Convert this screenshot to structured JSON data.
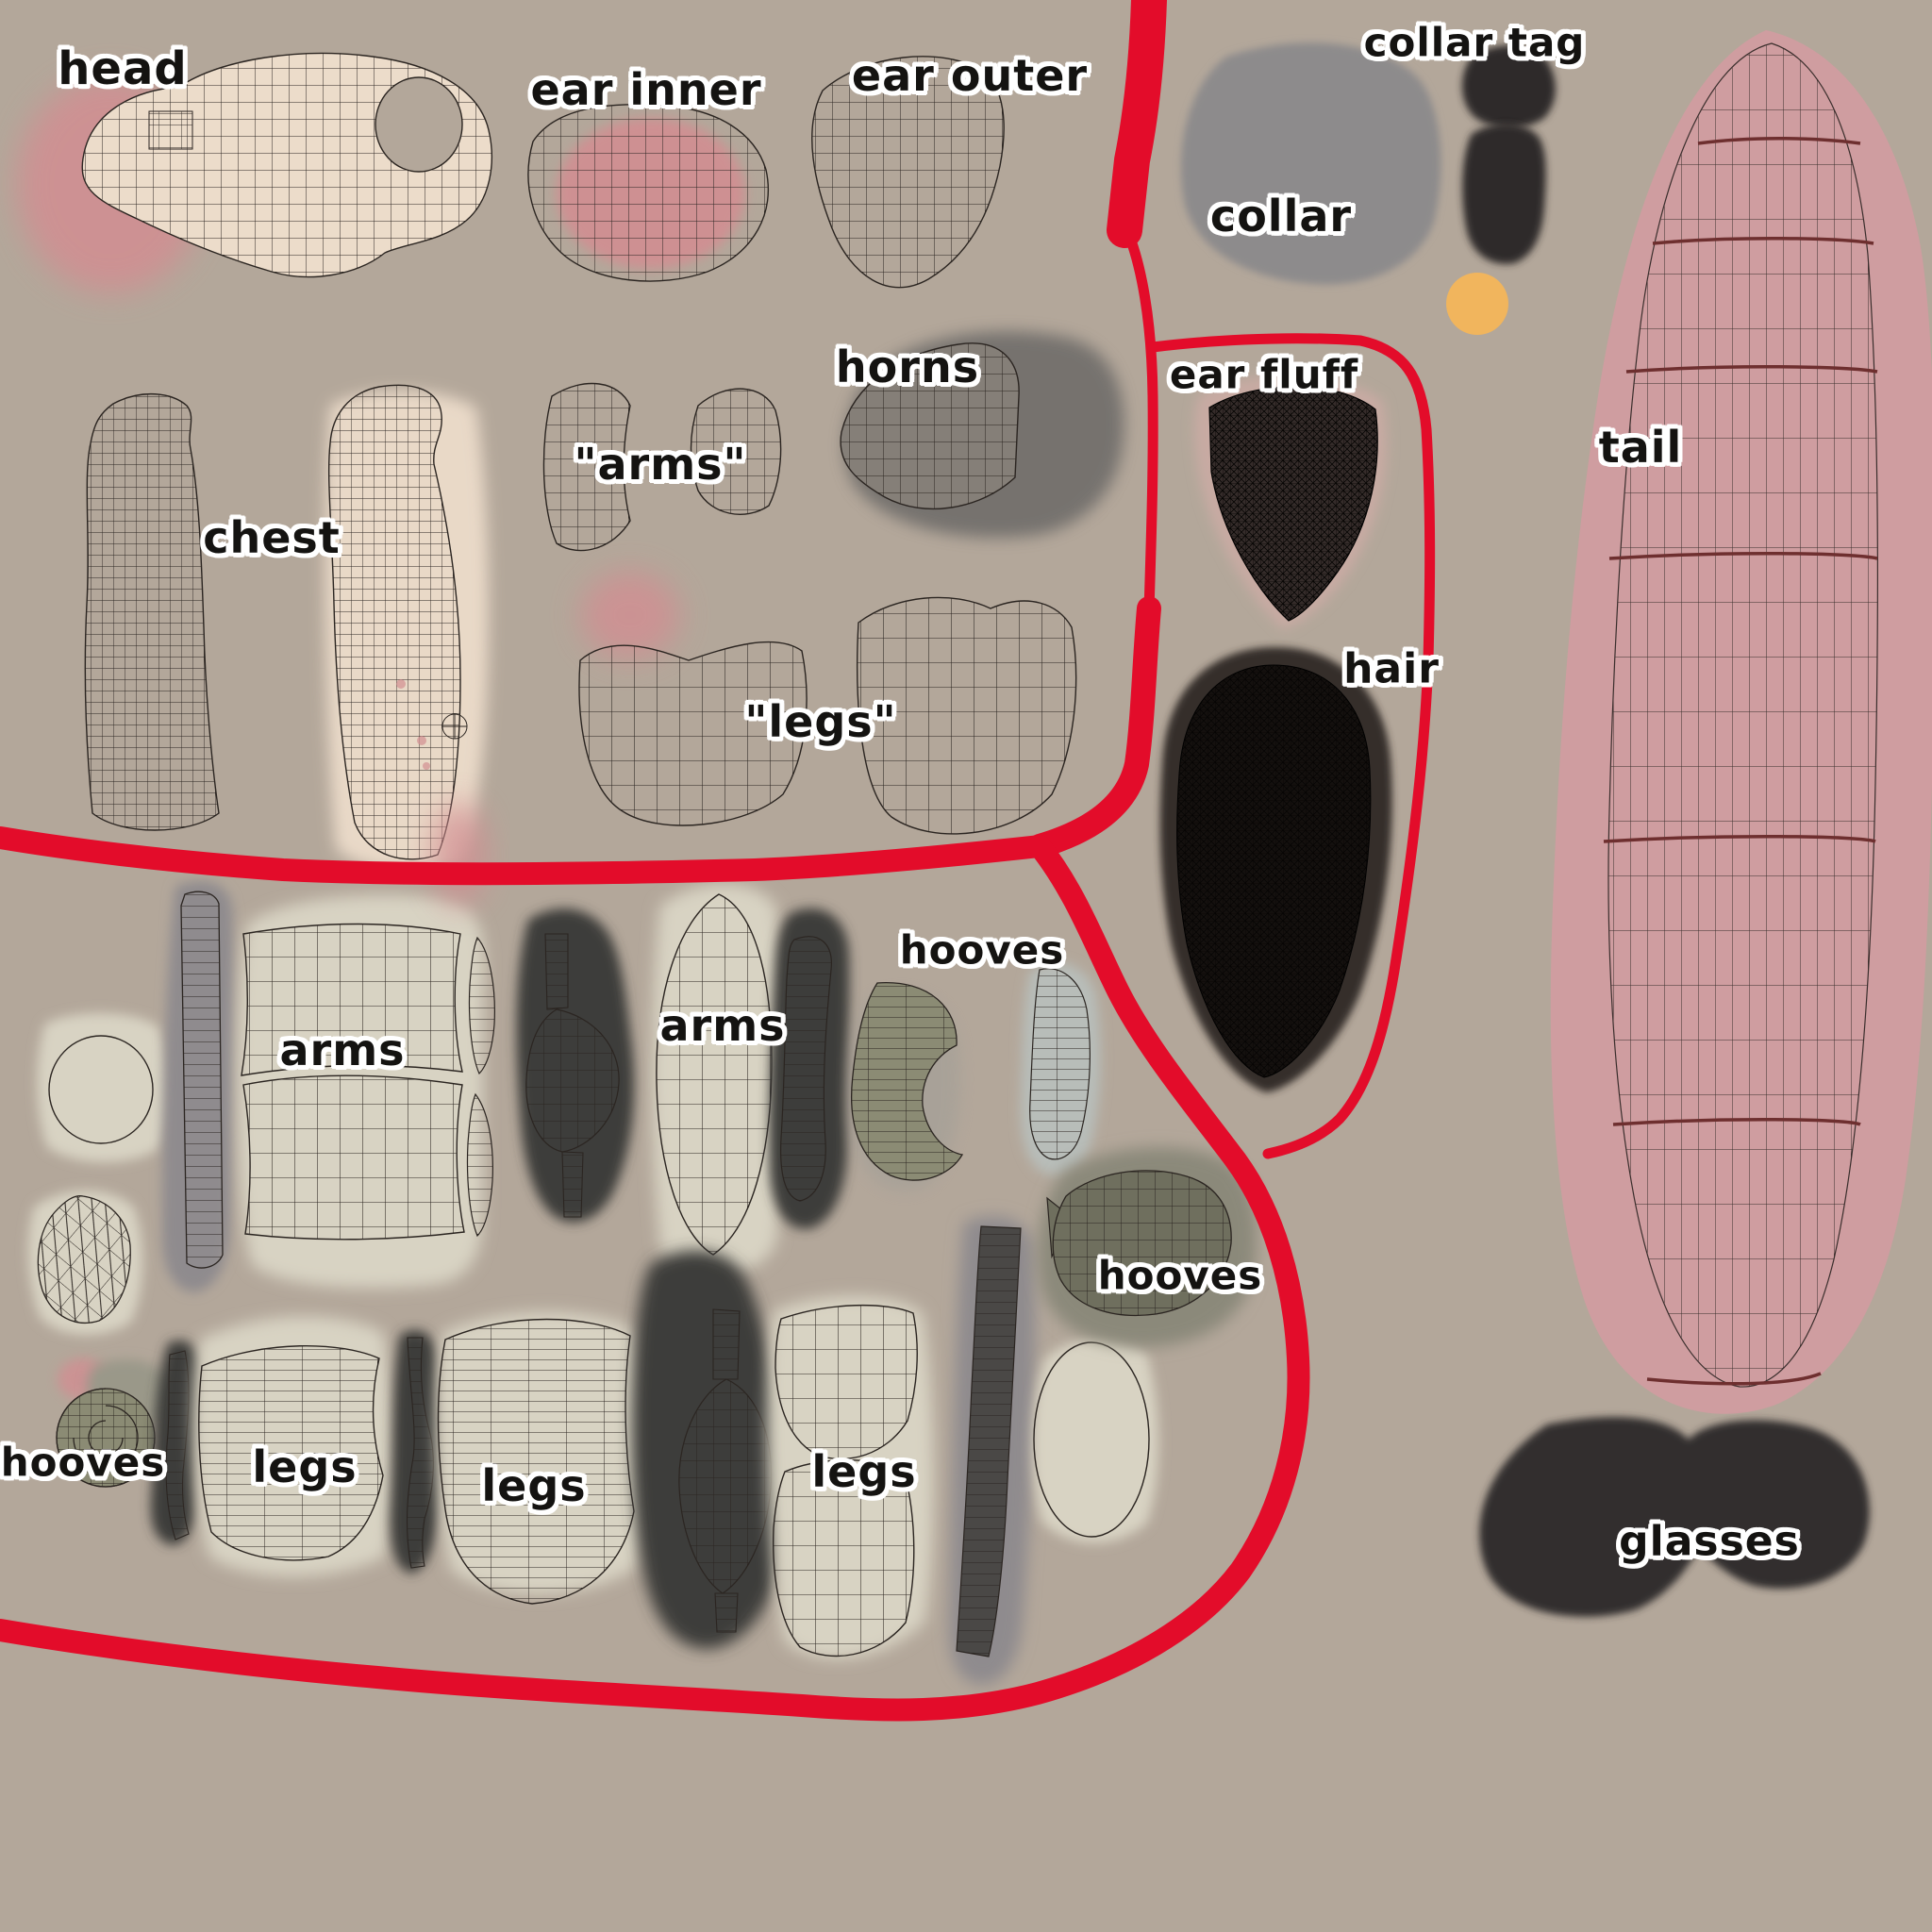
{
  "image_type": "uv-texture-map-reference",
  "palette": {
    "bg": "#b3a79a",
    "red": "#e30c2a",
    "ink": "#2b2521",
    "label": "#141311",
    "labelOutline": "#ffffff",
    "cream": "#ecdcca",
    "creamSoft": "#d8d3c3",
    "pink": "#d28e92",
    "tailPink": "#cf9da0",
    "tailLine": "#6e2f2f",
    "collarGray": "#8d8b8c",
    "strapGray": "#8f8b8e",
    "hornGray": "#857f78",
    "shadowGray": "#6f6d6a",
    "darkBlob": "#3e3c3a",
    "tagDark": "#2e2b29",
    "hairDark": "#362e2c",
    "fluffBack": "#c8aaa3",
    "orange": "#f1b55d",
    "olive": "#8b8b74",
    "oliveDeep": "#6f6f5e",
    "oliveBack": "#9a9889",
    "blueGray": "#b8bdb9",
    "glassesDark": "#332f2e"
  },
  "labels": [
    {
      "id": "head",
      "text": "head"
    },
    {
      "id": "ear-inner",
      "text": "ear inner"
    },
    {
      "id": "ear-outer",
      "text": "ear outer"
    },
    {
      "id": "collar-tag",
      "text": "collar tag"
    },
    {
      "id": "collar",
      "text": "collar"
    },
    {
      "id": "horns",
      "text": "horns"
    },
    {
      "id": "arms-q",
      "text": "\"arms\""
    },
    {
      "id": "chest",
      "text": "chest"
    },
    {
      "id": "ear-fluff",
      "text": "ear fluff"
    },
    {
      "id": "legs-q",
      "text": "\"legs\""
    },
    {
      "id": "hair",
      "text": "hair"
    },
    {
      "id": "tail",
      "text": "tail"
    },
    {
      "id": "arms-1",
      "text": "arms"
    },
    {
      "id": "arms-2",
      "text": "arms"
    },
    {
      "id": "hooves-1",
      "text": "hooves"
    },
    {
      "id": "hooves-2",
      "text": "hooves"
    },
    {
      "id": "hooves-3",
      "text": "hooves"
    },
    {
      "id": "legs-1",
      "text": "legs"
    },
    {
      "id": "legs-2",
      "text": "legs"
    },
    {
      "id": "legs-3",
      "text": "legs"
    },
    {
      "id": "glasses",
      "text": "glasses"
    }
  ]
}
